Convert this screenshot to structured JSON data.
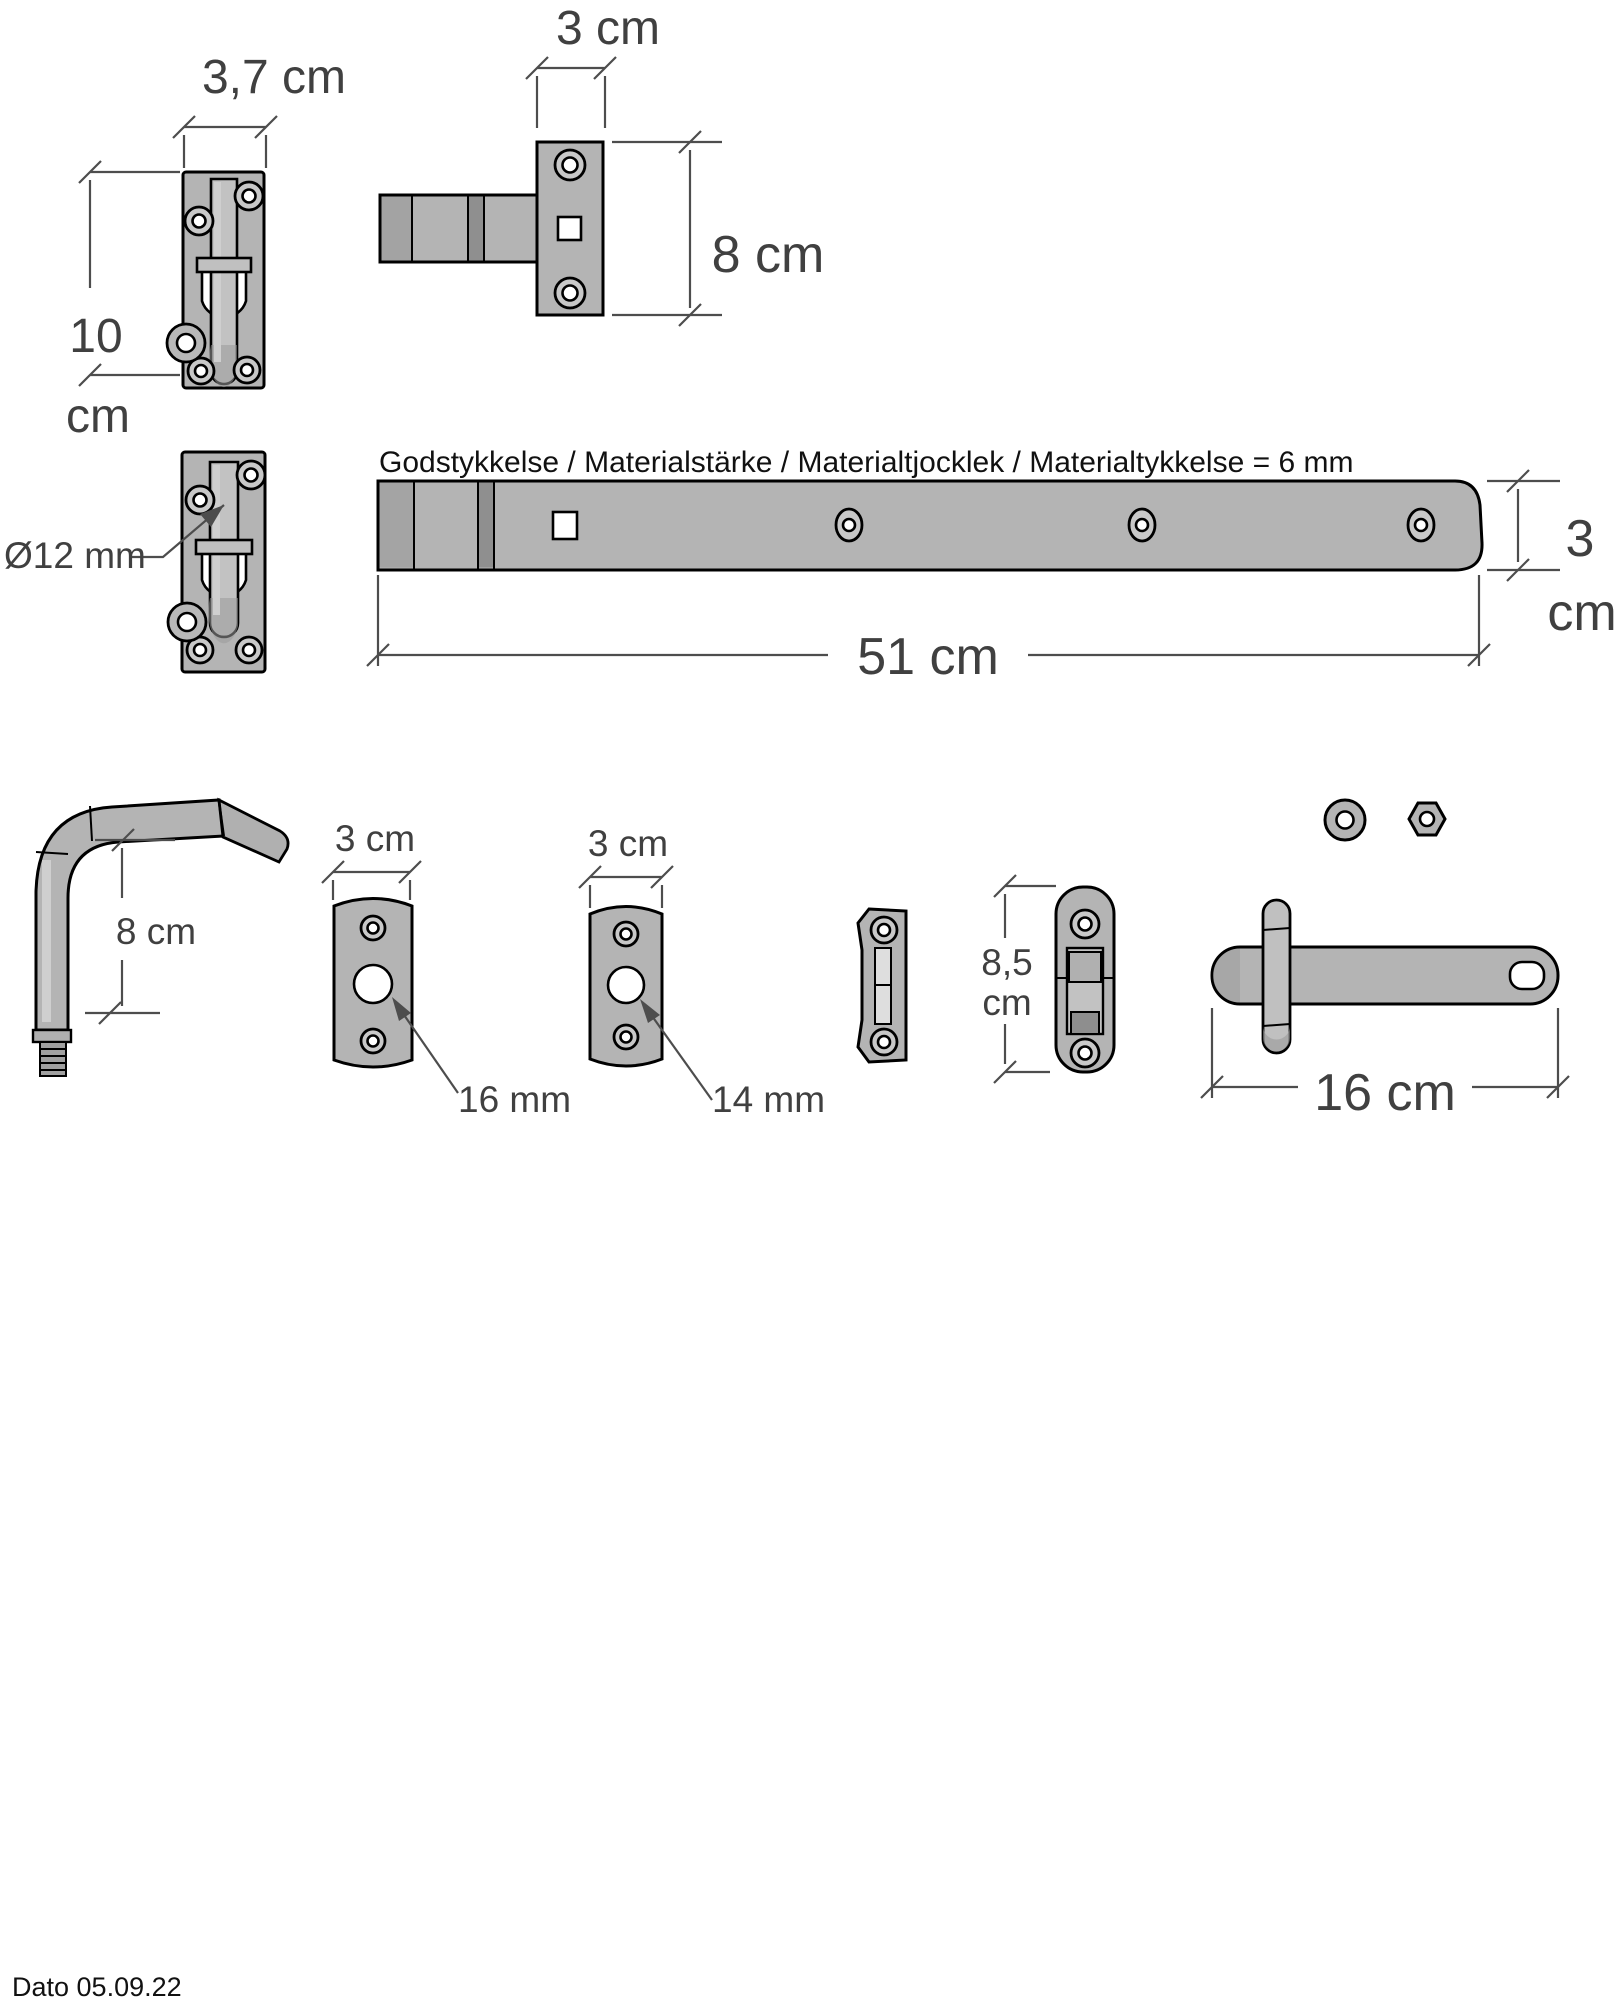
{
  "colors": {
    "background": "#ffffff",
    "metal": "#b4b4b4",
    "metal_dark": "#8f8f8f",
    "metal_light": "#cfcfcf",
    "outline": "#000000",
    "dimension": "#4d4d4d"
  },
  "note_material": "Godstykkelse / Materialstärke / Materialtjocklek / Materialtykkelse = 6 mm",
  "date_label": "Dato 05.09.22",
  "dims": {
    "bolt_latch_width": "3,7 cm",
    "bolt_latch_height_value": "10",
    "bolt_latch_height_unit": "cm",
    "hinge_keeper_width": "3 cm",
    "hinge_keeper_height": "8 cm",
    "bolt_rod_diameter": "Ø12 mm",
    "strap_length": "51 cm",
    "strap_width_value": "3",
    "strap_width_unit": "cm",
    "pin_length": "8 cm",
    "plate_a_width": "3 cm",
    "plate_a_hole": "16 mm",
    "plate_b_width": "3 cm",
    "plate_b_hole": "14 mm",
    "flip_latch_height_value": "8,5",
    "flip_latch_height_unit": "cm",
    "latch_bar_length": "16 cm"
  }
}
